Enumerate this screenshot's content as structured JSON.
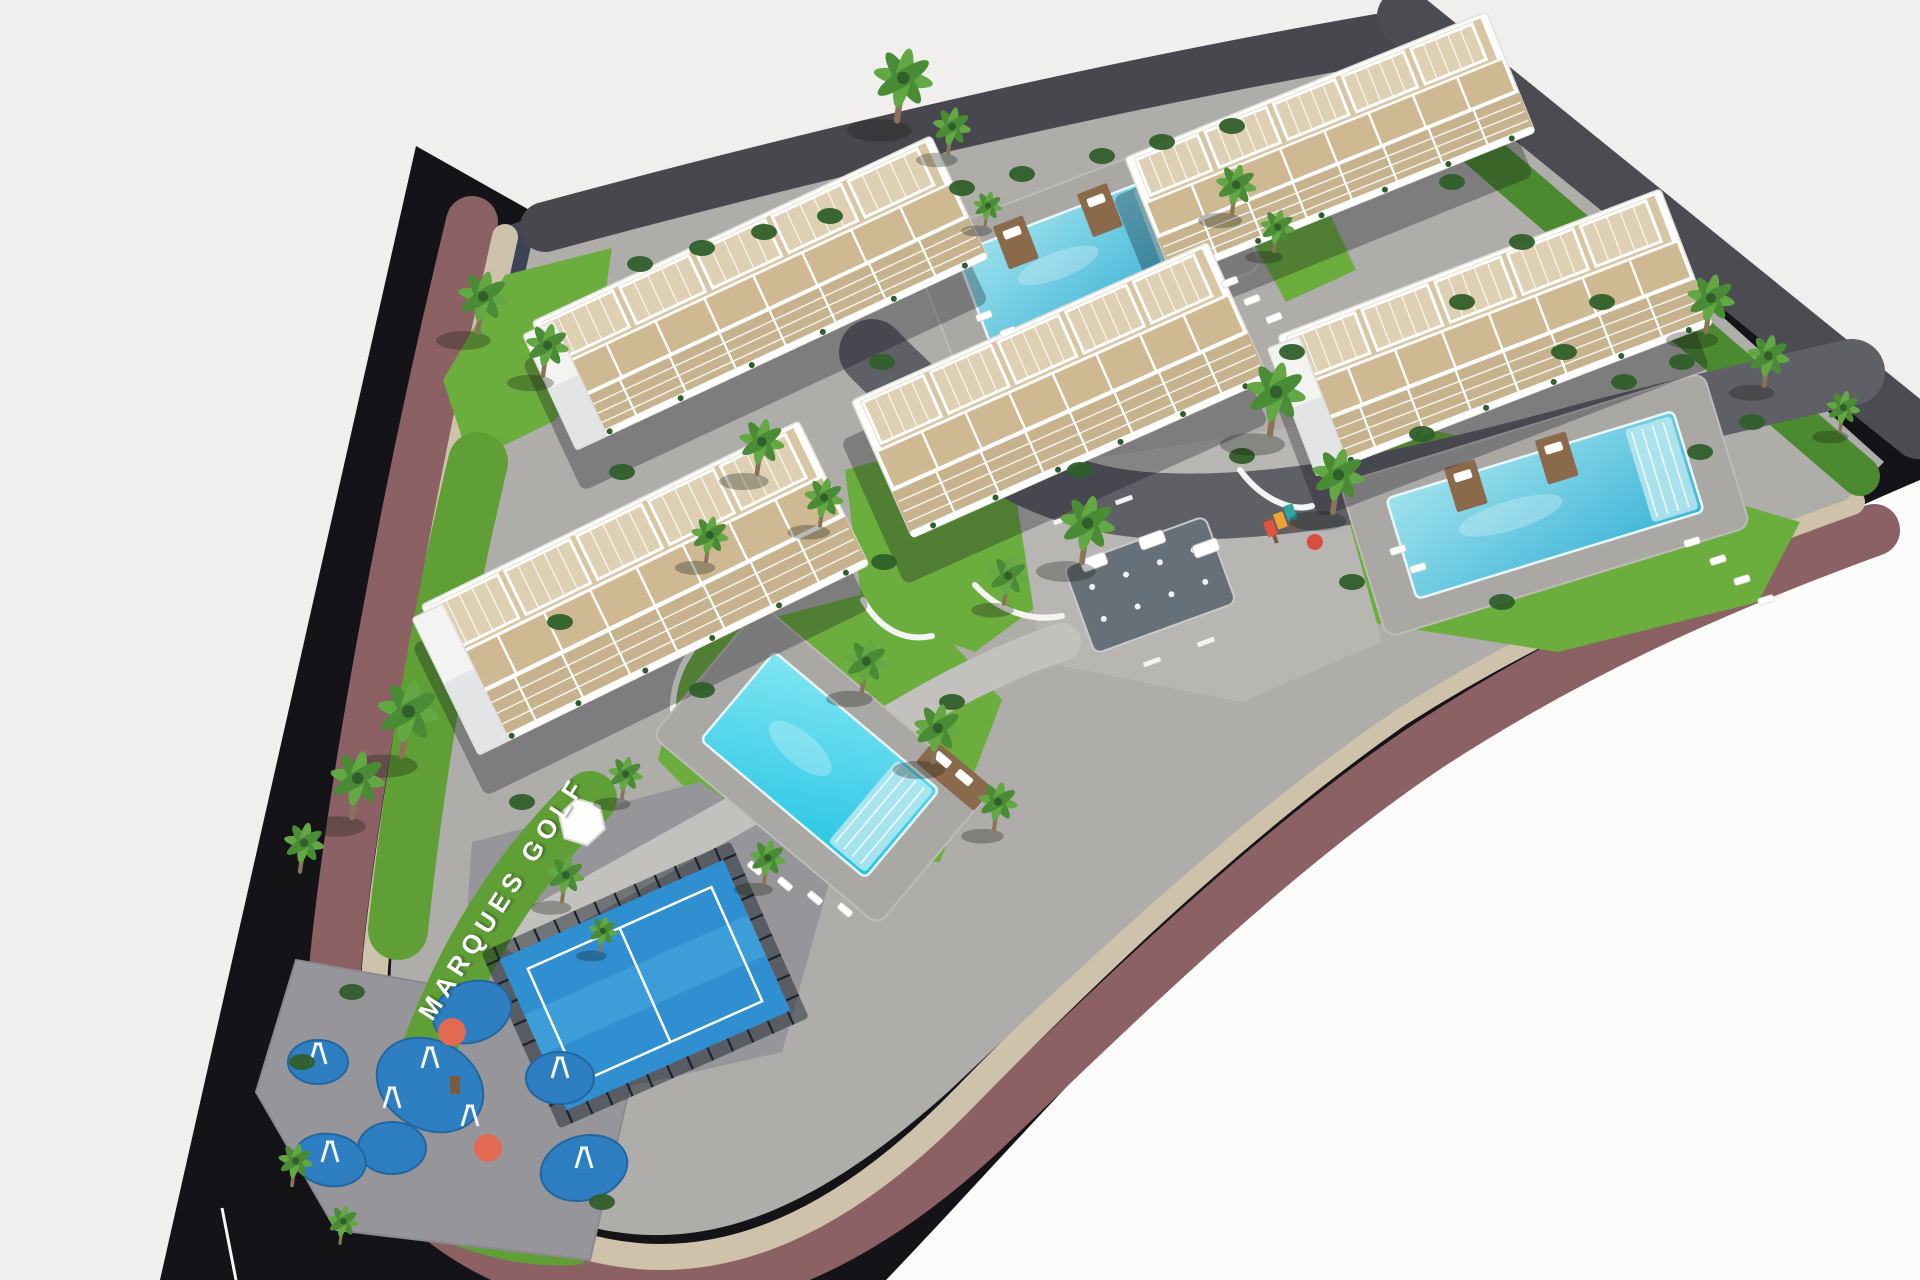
{
  "meta": {
    "description": "Aerial 3D architectural render of the Marques Golf residential complex: five white apartment buildings with rooftop pergola terraces, three swimming pools, padel court, children playground, palm gardens, surrounded by a curving dark road with a mauve retaining wall on an off-white background",
    "width": 1920,
    "height": 1280
  },
  "label": {
    "site_name": "MARQUES GOLF"
  },
  "palette": {
    "bg": "#f1efed",
    "bg_bright": "#fbfbfa",
    "road_black": "#141318",
    "embank1": "#3c4354",
    "embank2": "#262b38",
    "mauve": "#8b6164",
    "stone": "#cfc2aa",
    "wall_dark": "#4b4b52",
    "top_road": "#47474d",
    "paving": "#aeadaa",
    "paving_light": "#c2c1be",
    "paving_dark": "#96969a",
    "driveway": "#5f5f66",
    "plaza": "#b7b6b3",
    "grass": "#6cae3e",
    "grass_dark": "#4c8a2f",
    "hedge": "#5f9f35",
    "bush": "#2f5f2a",
    "palm": "#4a8c35",
    "palm_light": "#63a844",
    "trunk": "#8a7458",
    "building": "#fcfcfb",
    "building_edge": "#e0dfdc",
    "endcap": "#f3f3f1",
    "shade": "#d9dadd",
    "terrace": "#d8c5a3",
    "terrace2": "#cfb992",
    "terrace3": "#c6b28c",
    "pool_deck": "#a9a8a5",
    "water_hi": "#9fe2ec",
    "water_lo": "#3db4d8",
    "water_bright_hi": "#7fe6f2",
    "water_bright_lo": "#24c3e4",
    "wood": "#8a6a4b",
    "padel_floor": "#2f8fd0",
    "padel_light": "#4fb0e4",
    "fence": "#1c222b",
    "play_blue": "#2d7fc2",
    "play_blue_edge": "#22669f",
    "play_orange": "#e06a52",
    "splash": "#657078",
    "white": "#ffffff",
    "shadow": "rgba(16,16,28,0.30)"
  },
  "scene": {
    "regions": {
      "black_road": "M416,146 L160,1280 L886,1280 C992,1170 1120,1020 1296,860 C1472,704 1676,584 1920,480 L1920,428 L1404,16 C1100,84 760,160 540,216 Z",
      "bright_bg": "M886,1280 C992,1170 1120,1020 1296,860 C1472,704 1676,584 1920,480 L1920,1280 Z",
      "interior": "M532,242 C468,520 408,800 392,952 C380,1072 444,1178 572,1222 C702,1262 818,1208 948,1092 C1096,952 1246,812 1396,710 C1546,616 1696,553 1846,500 L1884,462 L1404,30 C1100,92 800,165 545,228 Z",
      "embank1": "455,245 545,212 522,420 432,478",
      "embank2": "432,486 520,432 484,700 392,742"
    },
    "bands": {
      "mauve": "M472,222 C402,510 352,800 336,958 C322,1102 398,1228 548,1274 C706,1320 852,1254 986,1128 C1128,992 1276,848 1428,746 C1578,648 1726,584 1874,530",
      "stone": "M505,237 C442,520 392,800 376,955 C363,1086 432,1196 576,1244 C720,1288 850,1216 966,1096 C1106,953 1252,816 1400,713 C1548,619 1700,556 1852,502",
      "top_road": "M545,227 C830,150 1120,83 1395,36",
      "wall_dark": "M1404,16 L1918,432",
      "wall_strip": "M1392,74 L1860,476",
      "left_grass": "M478,462 C440,620 414,780 398,930",
      "playground_rim": "M332,1012 C320,1100 360,1182 440,1222 C498,1247 540,1251 574,1249",
      "entry_hedge": "M430,1046 C462,960 512,872 590,798",
      "walkway": "M520,935 C650,862 760,802 862,742 C942,692 1002,662 1062,642",
      "driveway": "M872,352 C960,442 1042,502 1162,506 C1302,512 1452,472 1602,432 C1702,406 1792,386 1852,372"
    },
    "grass_polys": [
      "505,275 612,248 600,330 556,420 470,462 443,380",
      "845,470 1000,428 1092,470 1070,582 975,652 863,612",
      "688,640 902,584 1002,700 940,862 758,862 658,760",
      "1288,492 1430,430 1622,470 1800,522 1758,602 1558,652 1368,622 1288,560",
      "1253,242 1330,214 1356,270 1286,302",
      "558,842 622,820 642,862 590,886"
    ],
    "pads": {
      "plaza": "1012,472 1322,422 1382,642 1242,702 1042,662",
      "padel": "472,842 700,782 832,872 782,1052 562,1102 462,982",
      "playground": "296,960 520,1000 636,1060 590,1260 336,1230 256,1092"
    },
    "white_walls": [
      "M975,585 C1000,612 1032,622 1062,616",
      "M863,600 C880,630 906,642 932,636",
      "M1240,470 C1262,500 1292,512 1312,506",
      "M700,640 C676,668 668,700 676,730"
    ],
    "buildings": [
      {
        "cx": 1330,
        "cy": 145,
        "len": 390,
        "wid": 130,
        "ang": -22,
        "endcap": false
      },
      {
        "cx": 760,
        "cy": 290,
        "len": 440,
        "wid": 135,
        "ang": -25,
        "endcap": true
      },
      {
        "cx": 1495,
        "cy": 330,
        "len": 410,
        "wid": 145,
        "ang": -21,
        "endcap": true
      },
      {
        "cx": 1060,
        "cy": 390,
        "len": 390,
        "wid": 150,
        "ang": -24,
        "endcap": false
      },
      {
        "cx": 645,
        "cy": 585,
        "len": 420,
        "wid": 160,
        "ang": -26,
        "endcap": true
      }
    ],
    "pools": [
      {
        "cx": 1085,
        "cy": 255,
        "len": 240,
        "wid": 95,
        "ang": -21,
        "platforms": [
          -60,
          30
        ],
        "bright": false,
        "sidedeck": false
      },
      {
        "cx": 1545,
        "cy": 505,
        "len": 300,
        "wid": 105,
        "ang": -17,
        "platforms": [
          -70,
          25
        ],
        "bright": false,
        "sidedeck": false
      },
      {
        "cx": 820,
        "cy": 765,
        "len": 215,
        "wid": 115,
        "ang": 40,
        "platforms": [],
        "bright": true,
        "sidedeck": true
      }
    ],
    "padel_court": {
      "cx": 645,
      "cy": 985,
      "len": 245,
      "wid": 165,
      "ang": -24
    },
    "splash_pad": {
      "cx": 1150,
      "cy": 585,
      "len": 150,
      "wid": 92,
      "ang": -20
    },
    "gazebo": {
      "cx": 582,
      "cy": 822,
      "r": 24
    },
    "play_blobs": [
      [
        472,
        1012,
        40,
        30,
        -20
      ],
      [
        430,
        1085,
        56,
        44,
        30
      ],
      [
        392,
        1148,
        34,
        26,
        0
      ],
      [
        560,
        1078,
        34,
        26,
        0
      ],
      [
        584,
        1168,
        44,
        32,
        -15
      ],
      [
        318,
        1062,
        30,
        22,
        0
      ],
      [
        330,
        1160,
        36,
        26,
        10
      ]
    ],
    "play_orange": [
      [
        452,
        1032,
        14
      ],
      [
        488,
        1148,
        14
      ]
    ],
    "play_frames": [
      [
        430,
        1060
      ],
      [
        470,
        1118
      ],
      [
        392,
        1100
      ],
      [
        560,
        1070
      ],
      [
        584,
        1160
      ],
      [
        318,
        1056
      ],
      [
        330,
        1154
      ]
    ],
    "kids_corner": {
      "x": 1282,
      "y": 522
    },
    "palms": [
      [
        897,
        118,
        1.25
      ],
      [
        948,
        152,
        0.8
      ],
      [
        985,
        225,
        0.6
      ],
      [
        1232,
        212,
        0.85
      ],
      [
        1274,
        250,
        0.72
      ],
      [
        478,
        330,
        1.05
      ],
      [
        543,
        374,
        0.9
      ],
      [
        402,
        753,
        1.3
      ],
      [
        352,
        815,
        1.15
      ],
      [
        300,
        870,
        0.85
      ],
      [
        622,
        797,
        0.72
      ],
      [
        562,
        900,
        0.78
      ],
      [
        600,
        950,
        0.6
      ],
      [
        757,
        472,
        0.95
      ],
      [
        820,
        524,
        0.82
      ],
      [
        706,
        560,
        0.78
      ],
      [
        1082,
        560,
        1.15
      ],
      [
        1004,
        602,
        0.82
      ],
      [
        1270,
        432,
        1.25
      ],
      [
        1333,
        510,
        1.1
      ],
      [
        1706,
        330,
        1.0
      ],
      [
        1764,
        384,
        0.88
      ],
      [
        1840,
        430,
        0.7
      ],
      [
        862,
        690,
        0.9
      ],
      [
        933,
        760,
        1.0
      ],
      [
        994,
        828,
        0.82
      ],
      [
        764,
        882,
        0.75
      ],
      [
        292,
        1184,
        0.72
      ],
      [
        340,
        1242,
        0.65
      ]
    ],
    "bushes": [
      [
        640,
        264
      ],
      [
        702,
        248
      ],
      [
        764,
        232
      ],
      [
        830,
        216
      ],
      [
        962,
        188
      ],
      [
        1022,
        174
      ],
      [
        1102,
        156
      ],
      [
        1162,
        142
      ],
      [
        1232,
        126
      ],
      [
        1080,
        470
      ],
      [
        1242,
        456
      ],
      [
        1422,
        434
      ],
      [
        622,
        472
      ],
      [
        560,
        622
      ],
      [
        882,
        362
      ],
      [
        1292,
        352
      ],
      [
        1462,
        302
      ],
      [
        1564,
        352
      ],
      [
        1624,
        382
      ],
      [
        1700,
        452
      ],
      [
        1502,
        602
      ],
      [
        1352,
        582
      ],
      [
        702,
        690
      ],
      [
        952,
        702
      ],
      [
        884,
        562
      ],
      [
        522,
        802
      ],
      [
        352,
        992
      ],
      [
        302,
        1062
      ],
      [
        602,
        1202
      ],
      [
        1452,
        182
      ],
      [
        1522,
        242
      ],
      [
        1602,
        302
      ],
      [
        1682,
        362
      ],
      [
        1752,
        422
      ]
    ],
    "loungers": [
      [
        1230,
        282,
        -21
      ],
      [
        1252,
        300,
        -21
      ],
      [
        1274,
        318,
        -21
      ],
      [
        1008,
        332,
        -21
      ],
      [
        984,
        316,
        -21
      ],
      [
        1718,
        560,
        -17
      ],
      [
        1742,
        580,
        -17
      ],
      [
        1766,
        600,
        -17
      ],
      [
        1692,
        542,
        -17
      ],
      [
        1418,
        568,
        -17
      ],
      [
        1398,
        550,
        -17
      ],
      [
        755,
        868,
        40
      ],
      [
        785,
        884,
        40
      ],
      [
        815,
        898,
        40
      ],
      [
        845,
        910,
        40
      ]
    ],
    "cars": [
      [
        1152,
        540,
        -20
      ],
      [
        1206,
        548,
        -20
      ],
      [
        1094,
        562,
        -20
      ]
    ],
    "benches": [
      [
        1062,
        520,
        -20
      ],
      [
        1124,
        500,
        -20
      ],
      [
        1206,
        642,
        -20
      ],
      [
        1152,
        662,
        -20
      ]
    ],
    "lamp": {
      "x1": 222,
      "y1": 1208,
      "x2": 236,
      "y2": 1280
    }
  }
}
